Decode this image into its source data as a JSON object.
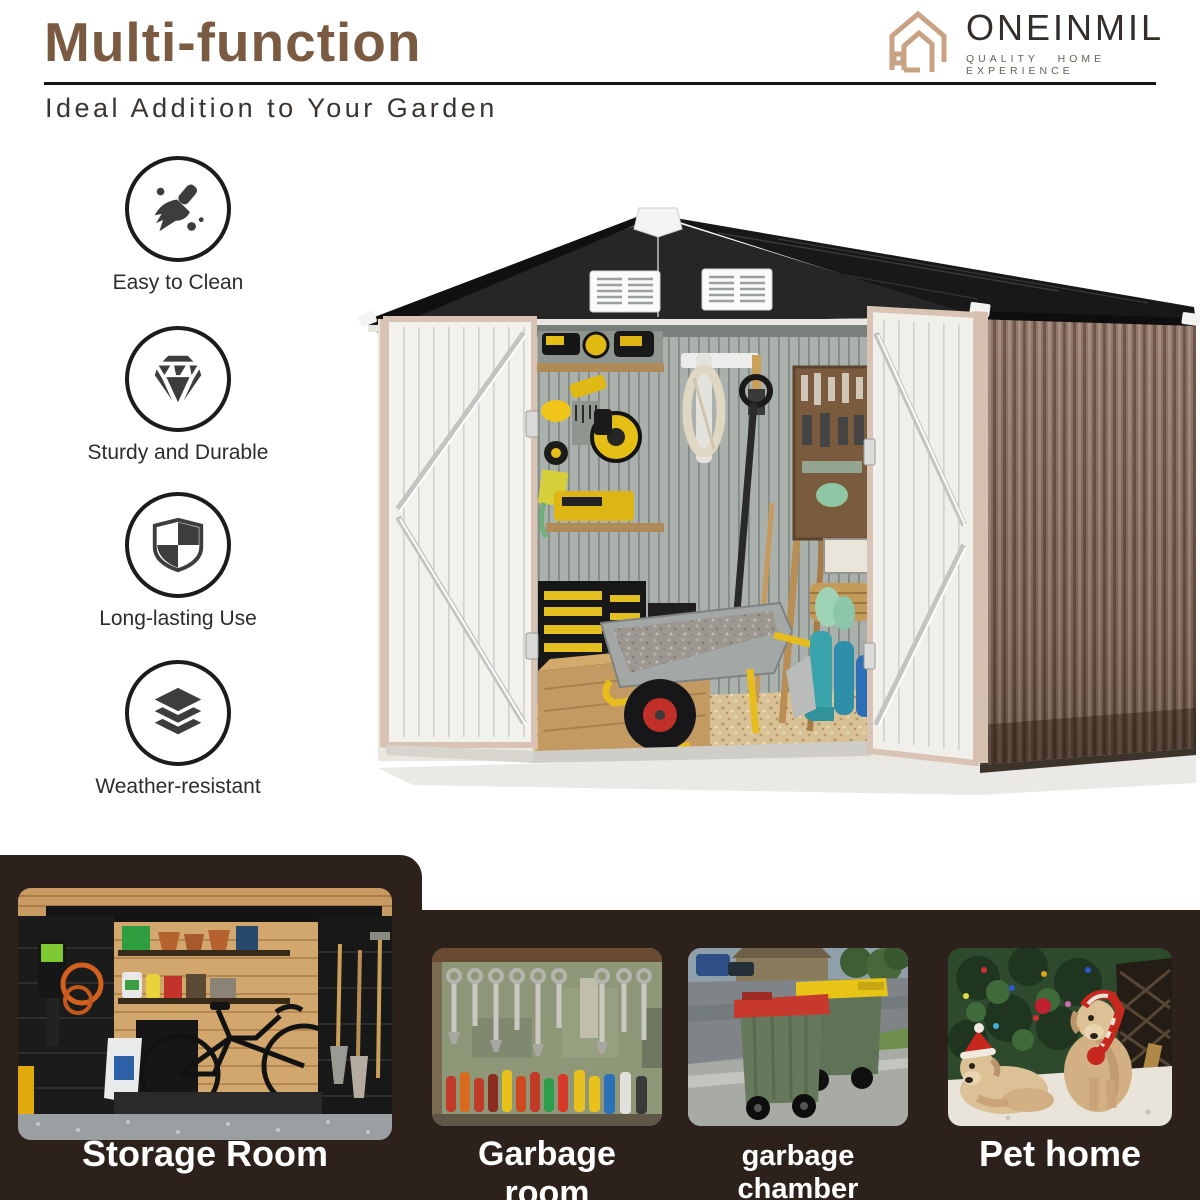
{
  "header": {
    "title": "Multi-function",
    "subtitle": "Ideal Addition to Your Garden"
  },
  "brand": {
    "name": "ONEINMIL",
    "tagline": "QUALITY HOME EXPERIENCE",
    "logo_icon": "house-outline-icon",
    "logo_color": "#c9a183",
    "name_color": "#332e29"
  },
  "features": [
    {
      "icon": "broom-icon",
      "label": "Easy to Clean"
    },
    {
      "icon": "diamond-icon",
      "label": "Sturdy and Durable"
    },
    {
      "icon": "shield-icon",
      "label": "Long-lasting Use"
    },
    {
      "icon": "layers-icon",
      "label": "Weather-resistant"
    }
  ],
  "hero": {
    "image": "metal-garden-shed-photo",
    "roof_color": "#1d1d1d",
    "door_color": "#f2f0ea",
    "side_wall_color": "#7d6353"
  },
  "showcase": {
    "band_color": "#2d211c",
    "items": [
      {
        "image": "storage-room-photo",
        "label": "Storage Room"
      },
      {
        "image": "garbage-room-photo",
        "label": "Garbage room"
      },
      {
        "image": "garbage-chamber-photo",
        "label": "garbage chamber"
      },
      {
        "image": "pet-home-photo",
        "label": "Pet home"
      }
    ]
  },
  "colors": {
    "title_brown": "#7a5a41",
    "text_dark": "#2c2c2c",
    "rule_black": "#161412"
  }
}
